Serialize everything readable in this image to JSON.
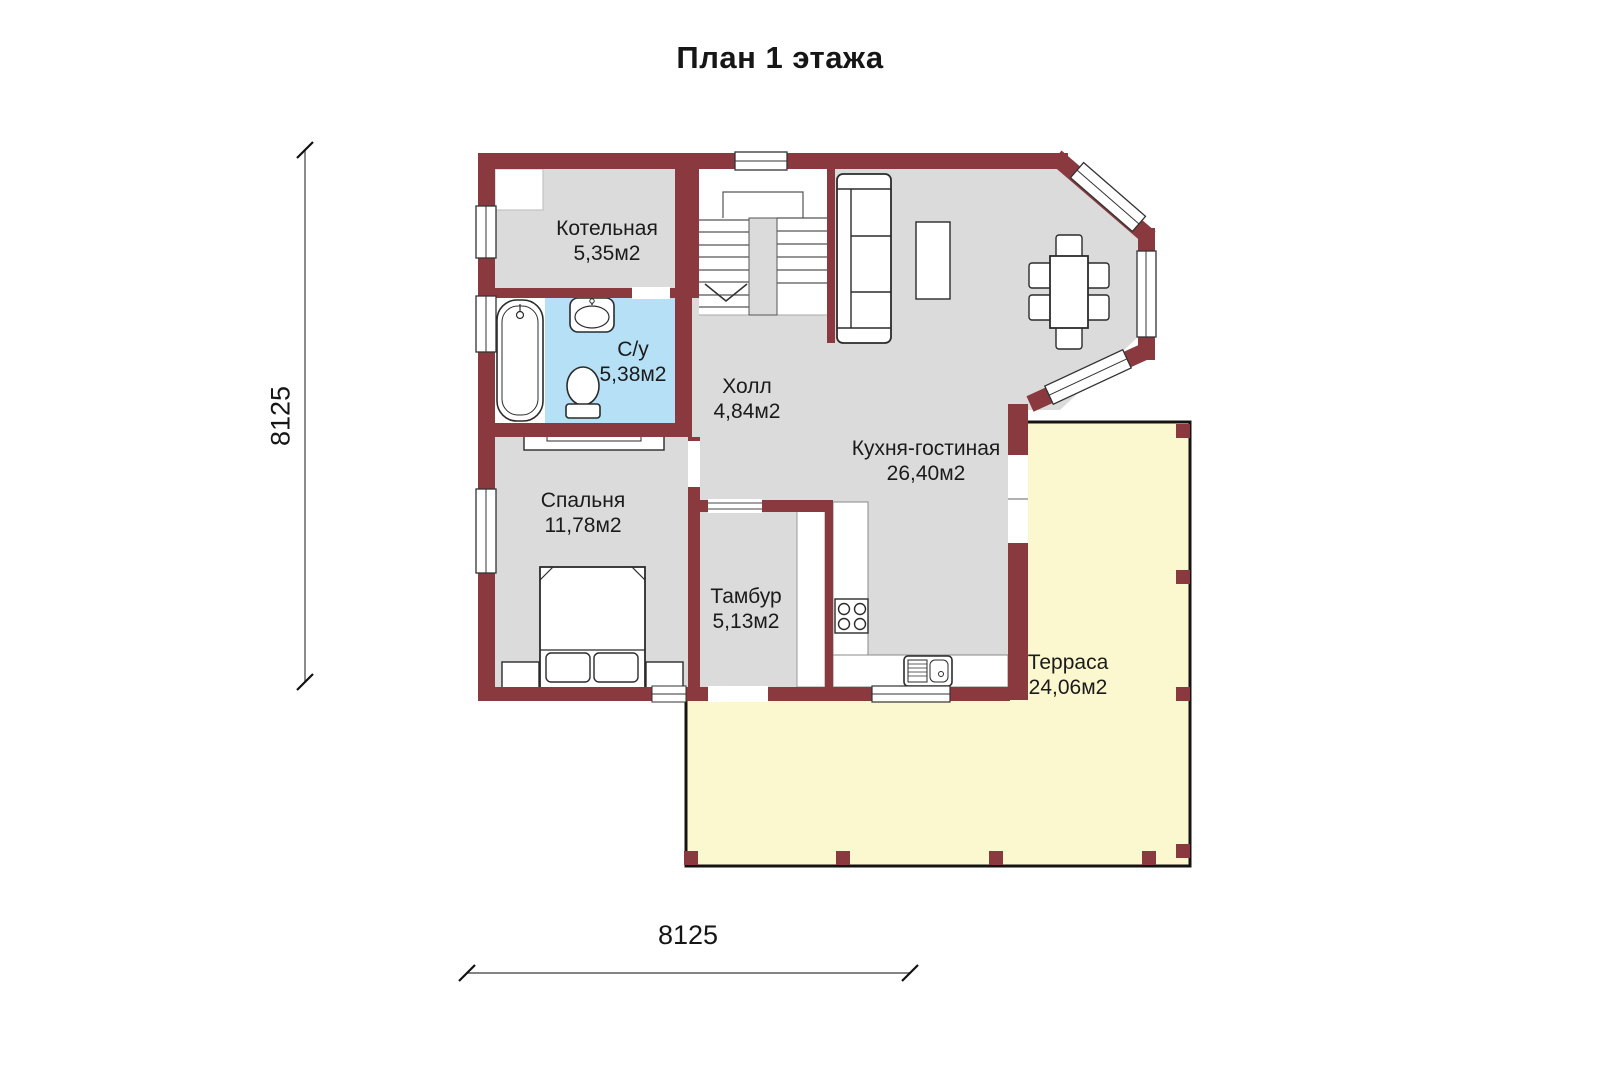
{
  "title": "План 1 этажа",
  "dimensions": {
    "height_mm": "8125",
    "width_mm": "8125"
  },
  "rooms": [
    {
      "name": "Котельная",
      "area": "5,35м2"
    },
    {
      "name": "С/у",
      "area": "5,38м2"
    },
    {
      "name": "Холл",
      "area": "4,84м2"
    },
    {
      "name": "Кухня-гостиная",
      "area": "26,40м2"
    },
    {
      "name": "Спальня",
      "area": "11,78м2"
    },
    {
      "name": "Тамбур",
      "area": "5,13м2"
    },
    {
      "name": "Терраса",
      "area": "24,06м2"
    }
  ],
  "colors": {
    "wall": "#8a3a3f",
    "floor": "#dbdbdb",
    "bathroom_floor": "#b6e0f5",
    "terrace_floor": "#fbf8cf",
    "background": "#ffffff",
    "outline": "#2b2b2b"
  },
  "fixtures": [
    "bathtub",
    "washbasin",
    "toilet",
    "staircase",
    "sofa",
    "coffee-table",
    "dining-table",
    "dining-chairs",
    "bed",
    "nightstands",
    "wardrobe",
    "boiler-unit",
    "stove",
    "kitchen-sink",
    "kitchen-counter",
    "tambour-closet",
    "terrace-posts"
  ]
}
